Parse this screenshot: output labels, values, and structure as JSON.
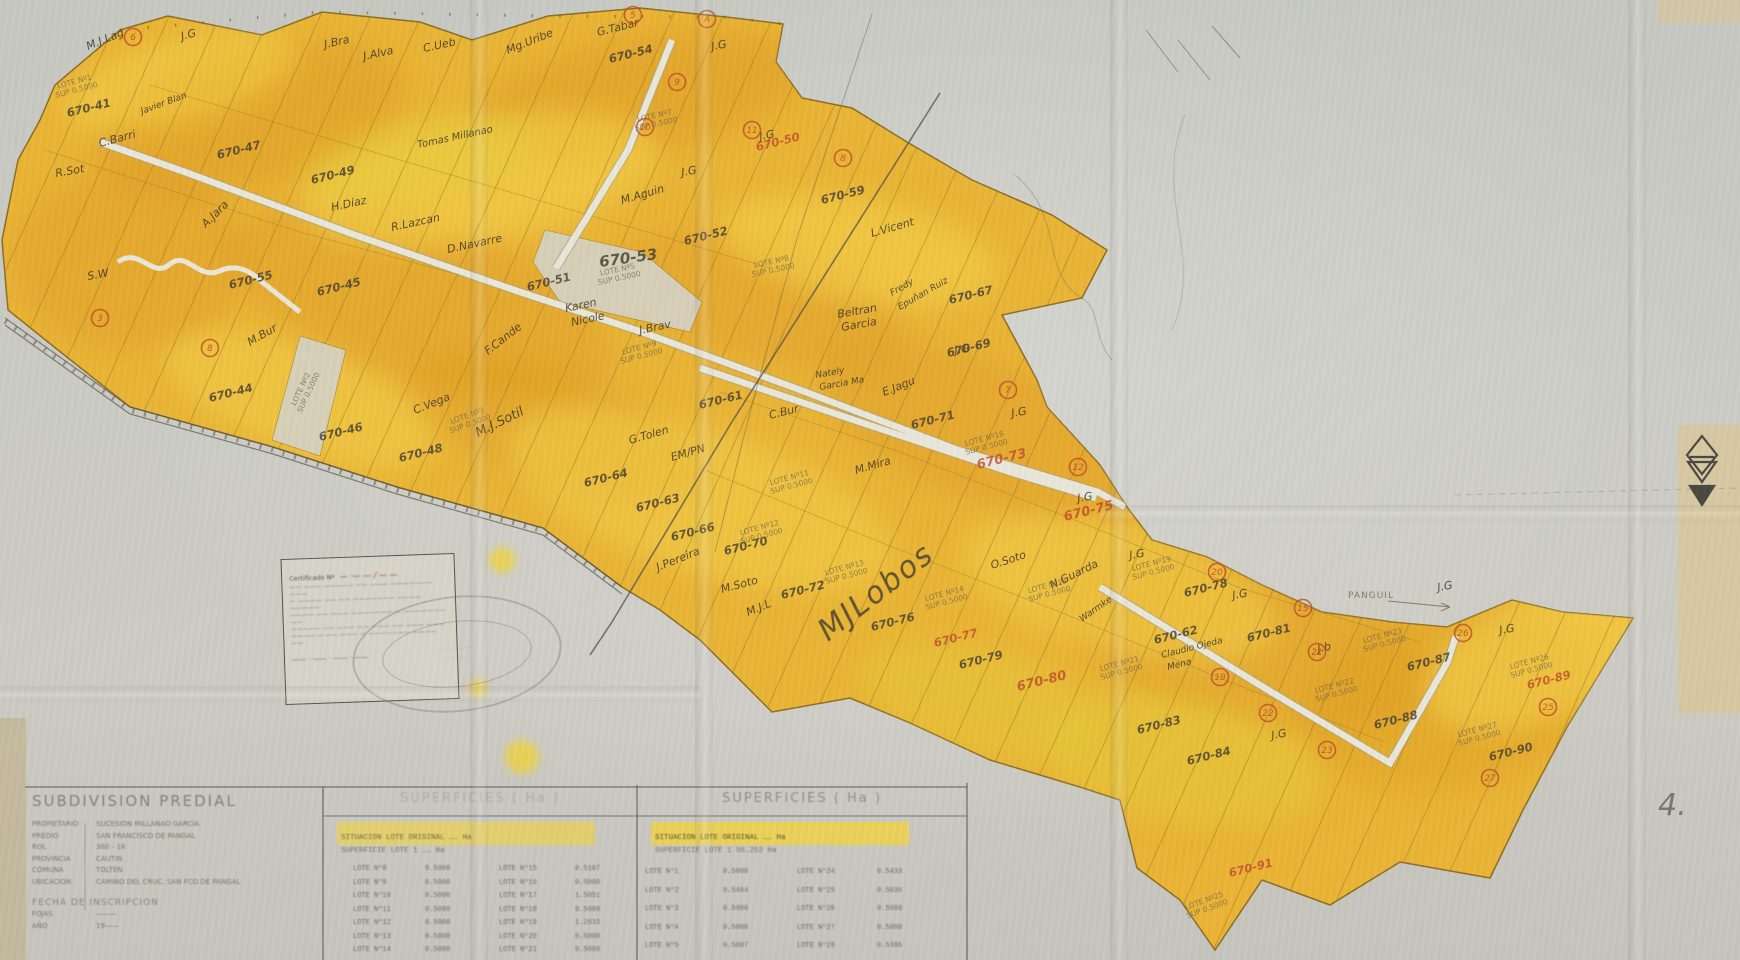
{
  "colors": {
    "paper": "#c9cac3",
    "parcel_yellow": "#ecb42f",
    "parcel_orange": "#de9a22",
    "parcel_light": "#f7d84e",
    "boundary_brown": "#9c7a20",
    "ink": "#3c382c",
    "red_ink": "#bf4b2b",
    "road_white": "#e9e7da"
  },
  "map": {
    "road_label": {
      "t": "PANGUIL",
      "x": 1348,
      "y": 598
    },
    "big_signature": {
      "t": "MJLobos",
      "x": 828,
      "y": 642,
      "r": -38
    },
    "page_mark": {
      "t": "4.",
      "x": 1658,
      "y": 815
    },
    "owner_labels": [
      {
        "t": "M.J.Lag",
        "x": 88,
        "y": 50,
        "r": -22
      },
      {
        "t": "J.G",
        "x": 182,
        "y": 40,
        "r": -15
      },
      {
        "t": "J.Bra",
        "x": 325,
        "y": 48,
        "r": -12
      },
      {
        "t": "J.Alva",
        "x": 364,
        "y": 60,
        "r": -12
      },
      {
        "t": "C.Ueb",
        "x": 424,
        "y": 52,
        "r": -12
      },
      {
        "t": "Mg.Uribe",
        "x": 508,
        "y": 54,
        "r": -22
      },
      {
        "t": "G.Tabar",
        "x": 598,
        "y": 36,
        "r": -14
      },
      {
        "t": "J.G",
        "x": 712,
        "y": 50,
        "r": -10
      },
      {
        "t": "J.G",
        "x": 760,
        "y": 140,
        "r": -10
      },
      {
        "t": "J.G",
        "x": 682,
        "y": 176,
        "r": -10
      },
      {
        "t": "M.Aguin",
        "x": 622,
        "y": 204,
        "r": -16
      },
      {
        "t": "Javier Blan",
        "x": 142,
        "y": 114,
        "r": -20,
        "s": 9
      },
      {
        "t": "C.Barri",
        "x": 100,
        "y": 147,
        "r": -15
      },
      {
        "t": "R.Sot",
        "x": 56,
        "y": 177,
        "r": -10
      },
      {
        "t": "Tomas Millanao",
        "x": 418,
        "y": 148,
        "r": -12,
        "s": 10,
        "c": "#5a5420"
      },
      {
        "t": "A.Jara",
        "x": 206,
        "y": 228,
        "r": -45
      },
      {
        "t": "S.W",
        "x": 88,
        "y": 280,
        "r": -10
      },
      {
        "t": "M.Bur",
        "x": 250,
        "y": 346,
        "r": -30
      },
      {
        "t": "H.Diaz",
        "x": 332,
        "y": 211,
        "r": -12
      },
      {
        "t": "R.Lazcan",
        "x": 392,
        "y": 231,
        "r": -12
      },
      {
        "t": "D.Navarre",
        "x": 448,
        "y": 253,
        "r": -12
      },
      {
        "t": "F.Cande",
        "x": 488,
        "y": 355,
        "r": -38
      },
      {
        "t": "C.Vega",
        "x": 415,
        "y": 414,
        "r": -22
      },
      {
        "t": "M.J.Sotil",
        "x": 478,
        "y": 437,
        "r": -26,
        "s": 13
      },
      {
        "t": "Karen",
        "x": 566,
        "y": 312,
        "r": -12
      },
      {
        "t": "Nicole",
        "x": 572,
        "y": 326,
        "r": -12
      },
      {
        "t": "J.Brav",
        "x": 640,
        "y": 334,
        "r": -12
      },
      {
        "t": "G.Tolen",
        "x": 630,
        "y": 444,
        "r": -16
      },
      {
        "t": "EM/PN",
        "x": 672,
        "y": 461,
        "r": -16
      },
      {
        "t": "C.Bur",
        "x": 770,
        "y": 419,
        "r": -14
      },
      {
        "t": "L.Vicent",
        "x": 872,
        "y": 237,
        "r": -16
      },
      {
        "t": "Beltran",
        "x": 838,
        "y": 318,
        "r": -10
      },
      {
        "t": "Garcia",
        "x": 842,
        "y": 331,
        "r": -10
      },
      {
        "t": "Fredy",
        "x": 892,
        "y": 296,
        "r": -30,
        "s": 9
      },
      {
        "t": "Epuñan Ruiz",
        "x": 900,
        "y": 310,
        "r": -30,
        "s": 9
      },
      {
        "t": "Nately",
        "x": 816,
        "y": 378,
        "r": -10,
        "s": 9
      },
      {
        "t": "Garcia Ma",
        "x": 820,
        "y": 390,
        "r": -10,
        "s": 9
      },
      {
        "t": "E.Jagu",
        "x": 884,
        "y": 396,
        "r": -22
      },
      {
        "t": "M.Mira",
        "x": 856,
        "y": 474,
        "r": -16
      },
      {
        "t": "J.Pereira",
        "x": 658,
        "y": 571,
        "r": -22
      },
      {
        "t": "M.Soto",
        "x": 722,
        "y": 593,
        "r": -15
      },
      {
        "t": "M.J.L",
        "x": 748,
        "y": 616,
        "r": -22
      },
      {
        "t": "O.Soto",
        "x": 992,
        "y": 569,
        "r": -18
      },
      {
        "t": "N.Guarda",
        "x": 1052,
        "y": 589,
        "r": -26
      },
      {
        "t": "Warmke",
        "x": 1082,
        "y": 622,
        "r": -35,
        "s": 9
      },
      {
        "t": "Claudio Ojeda",
        "x": 1162,
        "y": 658,
        "r": -14,
        "s": 9
      },
      {
        "t": "Mena",
        "x": 1168,
        "y": 670,
        "r": -14,
        "s": 9
      },
      {
        "t": "J.G",
        "x": 1130,
        "y": 559,
        "r": -10
      },
      {
        "t": "J.G",
        "x": 1233,
        "y": 599,
        "r": -10
      },
      {
        "t": "J.b",
        "x": 1318,
        "y": 652,
        "r": -10
      },
      {
        "t": "J.G",
        "x": 1272,
        "y": 739,
        "r": -10
      },
      {
        "t": "J.G",
        "x": 1500,
        "y": 634,
        "r": -10
      },
      {
        "t": "J.G",
        "x": 1438,
        "y": 591,
        "r": -10
      },
      {
        "t": "J.G",
        "x": 1012,
        "y": 417,
        "r": -10
      },
      {
        "t": "J.G",
        "x": 1078,
        "y": 502,
        "r": -10
      },
      {
        "t": "J.G",
        "x": 955,
        "y": 354,
        "r": -10
      }
    ],
    "parcel_numbers": [
      {
        "t": "670-41",
        "x": 68,
        "y": 117
      },
      {
        "t": "670-47",
        "x": 218,
        "y": 159
      },
      {
        "t": "670-49",
        "x": 312,
        "y": 184
      },
      {
        "t": "670-54",
        "x": 610,
        "y": 63
      },
      {
        "t": "670-50",
        "x": 757,
        "y": 151,
        "red": true
      },
      {
        "t": "670-59",
        "x": 822,
        "y": 204
      },
      {
        "t": "670-53",
        "x": 600,
        "y": 267,
        "s": 15,
        "r": -8
      },
      {
        "t": "670-51",
        "x": 528,
        "y": 291
      },
      {
        "t": "670-52",
        "x": 685,
        "y": 245
      },
      {
        "t": "670-55",
        "x": 230,
        "y": 289
      },
      {
        "t": "670-45",
        "x": 318,
        "y": 296
      },
      {
        "t": "670-44",
        "x": 210,
        "y": 402
      },
      {
        "t": "670-46",
        "x": 320,
        "y": 441
      },
      {
        "t": "670-48",
        "x": 400,
        "y": 462
      },
      {
        "t": "670-61",
        "x": 700,
        "y": 409
      },
      {
        "t": "670-64",
        "x": 585,
        "y": 487
      },
      {
        "t": "670-63",
        "x": 637,
        "y": 512
      },
      {
        "t": "670-66",
        "x": 672,
        "y": 541
      },
      {
        "t": "670-70",
        "x": 725,
        "y": 555
      },
      {
        "t": "670-72",
        "x": 782,
        "y": 599
      },
      {
        "t": "670-67",
        "x": 950,
        "y": 304
      },
      {
        "t": "670-69",
        "x": 948,
        "y": 357
      },
      {
        "t": "670-71",
        "x": 912,
        "y": 429
      },
      {
        "t": "670-73",
        "x": 978,
        "y": 469,
        "red": true,
        "s": 13
      },
      {
        "t": "670-75",
        "x": 1065,
        "y": 521,
        "red": true,
        "s": 13
      },
      {
        "t": "670-76",
        "x": 872,
        "y": 631
      },
      {
        "t": "670-77",
        "x": 935,
        "y": 647,
        "red": true
      },
      {
        "t": "670-79",
        "x": 960,
        "y": 669
      },
      {
        "t": "670-80",
        "x": 1018,
        "y": 691,
        "red": true,
        "s": 13
      },
      {
        "t": "670-78",
        "x": 1185,
        "y": 597
      },
      {
        "t": "670-81",
        "x": 1248,
        "y": 642
      },
      {
        "t": "670-62",
        "x": 1155,
        "y": 644
      },
      {
        "t": "670-83",
        "x": 1138,
        "y": 734
      },
      {
        "t": "670-84",
        "x": 1188,
        "y": 765
      },
      {
        "t": "670-87",
        "x": 1408,
        "y": 671
      },
      {
        "t": "670-88",
        "x": 1375,
        "y": 729
      },
      {
        "t": "670-89",
        "x": 1528,
        "y": 689,
        "red": true
      },
      {
        "t": "670-90",
        "x": 1490,
        "y": 761
      },
      {
        "t": "670-91",
        "x": 1230,
        "y": 877,
        "red": true
      }
    ],
    "lot_labels": [
      {
        "n": "LOTE Nº1",
        "x": 75,
        "y": 84,
        "r": -15
      },
      {
        "n": "LOTE Nº2",
        "x": 303,
        "y": 390,
        "r": -65
      },
      {
        "n": "LOTE Nº3",
        "x": 468,
        "y": 418,
        "r": -20
      },
      {
        "n": "LOTE Nº5",
        "x": 618,
        "y": 272,
        "r": -12
      },
      {
        "n": "LOTE Nº7",
        "x": 655,
        "y": 118,
        "r": -12
      },
      {
        "n": "LOTE Nº8",
        "x": 772,
        "y": 264,
        "r": -12
      },
      {
        "n": "LOTE Nº9",
        "x": 640,
        "y": 350,
        "r": -15
      },
      {
        "n": "LOTE Nº11",
        "x": 790,
        "y": 480,
        "r": -15
      },
      {
        "n": "LOTE Nº12",
        "x": 760,
        "y": 530,
        "r": -15
      },
      {
        "n": "LOTE Nº13",
        "x": 845,
        "y": 570,
        "r": -15
      },
      {
        "n": "LOTE Nº14",
        "x": 945,
        "y": 596,
        "r": -15
      },
      {
        "n": "LOTE Nº16",
        "x": 985,
        "y": 441,
        "r": -15
      },
      {
        "n": "LOTE Nº18",
        "x": 1048,
        "y": 588,
        "r": -15
      },
      {
        "n": "LOTE Nº19",
        "x": 1152,
        "y": 566,
        "r": -15
      },
      {
        "n": "LOTE Nº21",
        "x": 1120,
        "y": 666,
        "r": -15
      },
      {
        "n": "LOTE Nº22",
        "x": 1335,
        "y": 688,
        "r": -15
      },
      {
        "n": "LOTE Nº23",
        "x": 1383,
        "y": 638,
        "r": -15
      },
      {
        "n": "LOTE Nº25",
        "x": 1205,
        "y": 903,
        "r": -20
      },
      {
        "n": "LOTE Nº26",
        "x": 1530,
        "y": 664,
        "r": -15
      },
      {
        "n": "LOTE Nº27",
        "x": 1478,
        "y": 732,
        "r": -15
      }
    ],
    "lot_sub": "SUP 0.5000",
    "markers": [
      {
        "t": "6",
        "x": 133,
        "y": 37
      },
      {
        "t": "5",
        "x": 633,
        "y": 15
      },
      {
        "t": "A",
        "x": 707,
        "y": 19
      },
      {
        "t": "9",
        "x": 677,
        "y": 82
      },
      {
        "t": "10",
        "x": 645,
        "y": 127
      },
      {
        "t": "11",
        "x": 752,
        "y": 130
      },
      {
        "t": "8",
        "x": 843,
        "y": 158
      },
      {
        "t": "3",
        "x": 100,
        "y": 318
      },
      {
        "t": "8",
        "x": 210,
        "y": 348
      },
      {
        "t": "7",
        "x": 1008,
        "y": 390
      },
      {
        "t": "12",
        "x": 1078,
        "y": 467
      },
      {
        "t": "20",
        "x": 1217,
        "y": 572
      },
      {
        "t": "15",
        "x": 1303,
        "y": 608
      },
      {
        "t": "21",
        "x": 1317,
        "y": 652
      },
      {
        "t": "19",
        "x": 1220,
        "y": 677
      },
      {
        "t": "22",
        "x": 1268,
        "y": 713
      },
      {
        "t": "23",
        "x": 1327,
        "y": 750
      },
      {
        "t": "26",
        "x": 1463,
        "y": 633
      },
      {
        "t": "25",
        "x": 1548,
        "y": 707
      },
      {
        "t": "27",
        "x": 1490,
        "y": 778
      }
    ]
  },
  "certificate": {
    "header": "Certificado Nº",
    "number": "— ·— — / — —",
    "body": [
      "—— ——— ————— —— ——— ——————— ———",
      "— ———— —— —— ——————— ———— —————",
      "———— —— ——— ——————— — ——————— ——",
      "————— —— ——— —— ——— —— ——— ———",
      "———— — —— ——— — ——————— ———— ——"
    ],
    "sign": "—— · —— · —— · ——"
  },
  "stamp": {
    "line1": "· · · · · · ·",
    "line2": "· · · · ·"
  },
  "title_block": {
    "title": "SUBDIVISION PREDIAL",
    "fields": [
      {
        "label": "PROPIETARIO",
        "value": "SUCESION MILLANAO GARCIA"
      },
      {
        "label": "PREDIO",
        "value": "SAN FRANCISCO DE PANGAL"
      },
      {
        "label": "ROL",
        "value": "360 - 18"
      },
      {
        "label": "PROVINCIA",
        "value": "CAUTIN"
      },
      {
        "label": "COMUNA",
        "value": "TOLTEN"
      },
      {
        "label": "UBICACION",
        "value": "CAMINO DEL CRUC. SAN FCO DE PANGAL"
      }
    ],
    "footer_title": "FECHA DE INSCRIPCION",
    "footer_fields": [
      {
        "label": "FOJAS",
        "value": "———"
      },
      {
        "label": "AÑO",
        "value": "19——"
      }
    ]
  },
  "tables": {
    "left": {
      "title": "SUPERFICIES ( Ha )",
      "highlight": "SITUACION LOTE ORIGINAL  ……  Ha",
      "subline": "SUPERFICIE LOTE 1      …… Ha",
      "rows": [
        {
          "l1": "LOTE Nº8",
          "v1": "0.5000",
          "l2": "LOTE Nº15",
          "v2": "0.5187"
        },
        {
          "l1": "LOTE Nº9",
          "v1": "0.5000",
          "l2": "LOTE Nº16",
          "v2": "0.5000"
        },
        {
          "l1": "LOTE Nº10",
          "v1": "0.5000",
          "l2": "LOTE Nº17",
          "v2": "1.5051"
        },
        {
          "l1": "LOTE Nº11",
          "v1": "0.5000",
          "l2": "LOTE Nº18",
          "v2": "0.5000"
        },
        {
          "l1": "LOTE Nº12",
          "v1": "0.5000",
          "l2": "LOTE Nº19",
          "v2": "1.2633"
        },
        {
          "l1": "LOTE Nº13",
          "v1": "0.5000",
          "l2": "LOTE Nº20",
          "v2": "0.5000"
        },
        {
          "l1": "LOTE Nº14",
          "v1": "0.5000",
          "l2": "LOTE Nº21",
          "v2": "0.5000"
        }
      ]
    },
    "right": {
      "title": "SUPERFICIES ( Ha )",
      "highlight": "SITUACION LOTE ORIGINAL  ……  Ha",
      "subline": "SUPERFICIE LOTE 1      56.252 Ha",
      "rows": [
        {
          "l1": "LOTE Nº1",
          "v1": "0.5000",
          "l2": "LOTE Nº24",
          "v2": "0.5433"
        },
        {
          "l1": "LOTE Nº2",
          "v1": "0.5464",
          "l2": "LOTE Nº25",
          "v2": "0.5036"
        },
        {
          "l1": "LOTE Nº3",
          "v1": "0.5000",
          "l2": "LOTE Nº26",
          "v2": "0.5000"
        },
        {
          "l1": "LOTE Nº4",
          "v1": "0.5000",
          "l2": "LOTE Nº27",
          "v2": "0.5000"
        },
        {
          "l1": "LOTE Nº5",
          "v1": "0.5007",
          "l2": "LOTE Nº28",
          "v2": "0.5386"
        },
        {
          "l1": "LOTE Nº6",
          "v1": "0.5000",
          "l2": "LOTE Nº29",
          "v2": "0.5036"
        },
        {
          "l1": "LOTE Nº7",
          "v1": "0.5000",
          "l2": "",
          "v2": ""
        }
      ]
    }
  }
}
